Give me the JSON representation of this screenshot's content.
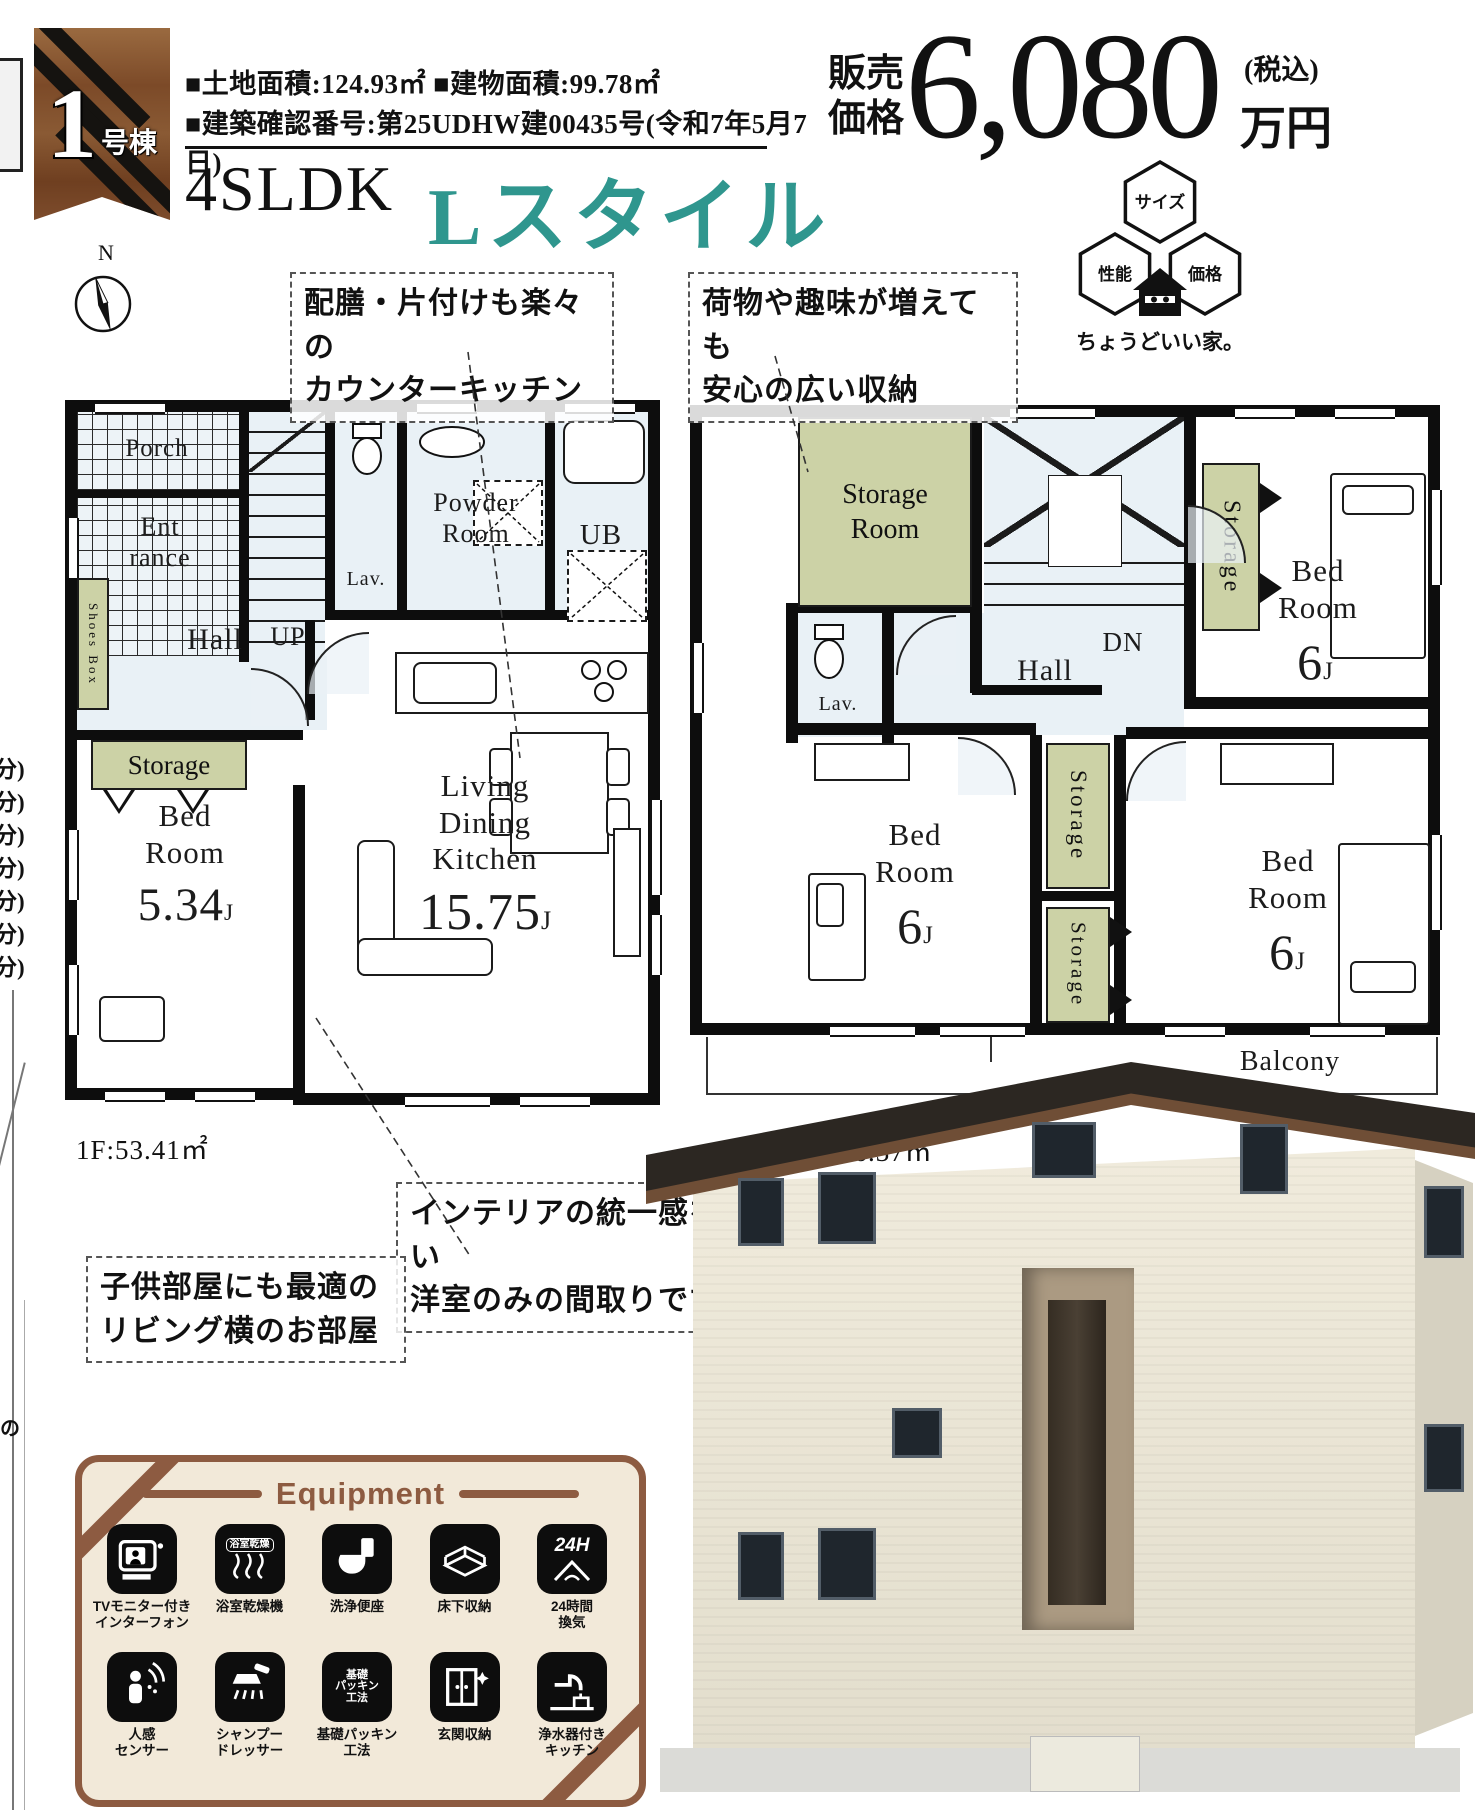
{
  "badge": {
    "number": "1",
    "suffix": "号棟"
  },
  "header": {
    "area_line": "■土地面積:124.93㎡ ■建物面積:99.78㎡",
    "permit_line": "■建築確認番号:第25UDHW建00435号(令和7年5月7日)",
    "layout_type": "4SLDK",
    "style_name": "Lスタイル"
  },
  "price": {
    "label": "販売\n価格",
    "amount": "6,080",
    "tax": "(税込)",
    "unit": "万円"
  },
  "logo": {
    "top": "サイズ",
    "left": "性能",
    "right": "価格",
    "tagline": "ちょうどいい家。"
  },
  "compass": {
    "n": "N"
  },
  "callouts": {
    "kitchen": "配膳・片付けも楽々の\nカウンターキッチン",
    "storage": "荷物や趣味が増えても\n安心の広い収納",
    "interior": "インテリアの統一感を作りやすい\n洋室のみの間取りです",
    "kids": "子供部屋にも最適の\nリビング横のお部屋"
  },
  "floor1": {
    "area": "1F:53.41㎡",
    "porch": "Porch",
    "entrance": "Ent\nrance",
    "up": "UP",
    "lav": "Lav.",
    "powder": "Powder\nRoom",
    "ub": "UB",
    "hall": "Hall",
    "shoes": "Shoes Box",
    "storage": "Storage",
    "bed": "Bed\nRoom",
    "bed_size": "5.34",
    "bed_unit": "J",
    "ldk": "Living\nDining\nKitchen",
    "ldk_size": "15.75",
    "ldk_unit": "J"
  },
  "floor2": {
    "area": "2F:46.37㎡",
    "storage_room": "Storage\nRoom",
    "dn": "DN",
    "lav": "Lav.",
    "hall": "Hall",
    "storage_a": "Storage",
    "storage_b": "Storage",
    "storage_c": "Storage",
    "storage_d": "Storage",
    "bed1": "Bed\nRoom",
    "bed1_size": "6",
    "bed1_unit": "J",
    "bed2": "Bed\nRoom",
    "bed2_size": "6",
    "bed2_unit": "J",
    "bed3": "Bed\nRoom",
    "bed3_size": "6",
    "bed3_unit": "J",
    "balcony": "Balcony"
  },
  "equipment": {
    "title": "Equipment",
    "items": [
      {
        "icon": "intercom-icon",
        "label": "TVモニター付き\nインターフォン"
      },
      {
        "icon": "bath-dryer-icon",
        "icon_text": "浴室乾燥",
        "label": "浴室乾燥機"
      },
      {
        "icon": "washlet-icon",
        "label": "洗浄便座"
      },
      {
        "icon": "underfloor-storage-icon",
        "label": "床下収納"
      },
      {
        "icon": "ventilation-24h-icon",
        "icon_text": "24H",
        "label": "24時間\n換気"
      },
      {
        "icon": "motion-sensor-icon",
        "label": "人感\nセンサー"
      },
      {
        "icon": "shampoo-dresser-icon",
        "label": "シャンプー\nドレッサー"
      },
      {
        "icon": "foundation-packing-icon",
        "icon_text": "基礎\nパッキン\n工法",
        "label": "基礎パッキン\n工法"
      },
      {
        "icon": "entrance-storage-icon",
        "label": "玄関収納"
      },
      {
        "icon": "water-purifier-icon",
        "label": "浄水器付き\nキッチン"
      }
    ]
  },
  "left_edge": {
    "fragments": [
      "分)",
      "分)",
      "分)",
      "分)",
      "分)",
      "分)",
      "分)"
    ],
    "char": "の"
  },
  "colors": {
    "teal": "#2f968e",
    "storage_green": "#ccd2a6",
    "brown": "#8d5b41",
    "panel_bg": "#f2e9d9",
    "floor_blue": "#e9f1f6"
  }
}
